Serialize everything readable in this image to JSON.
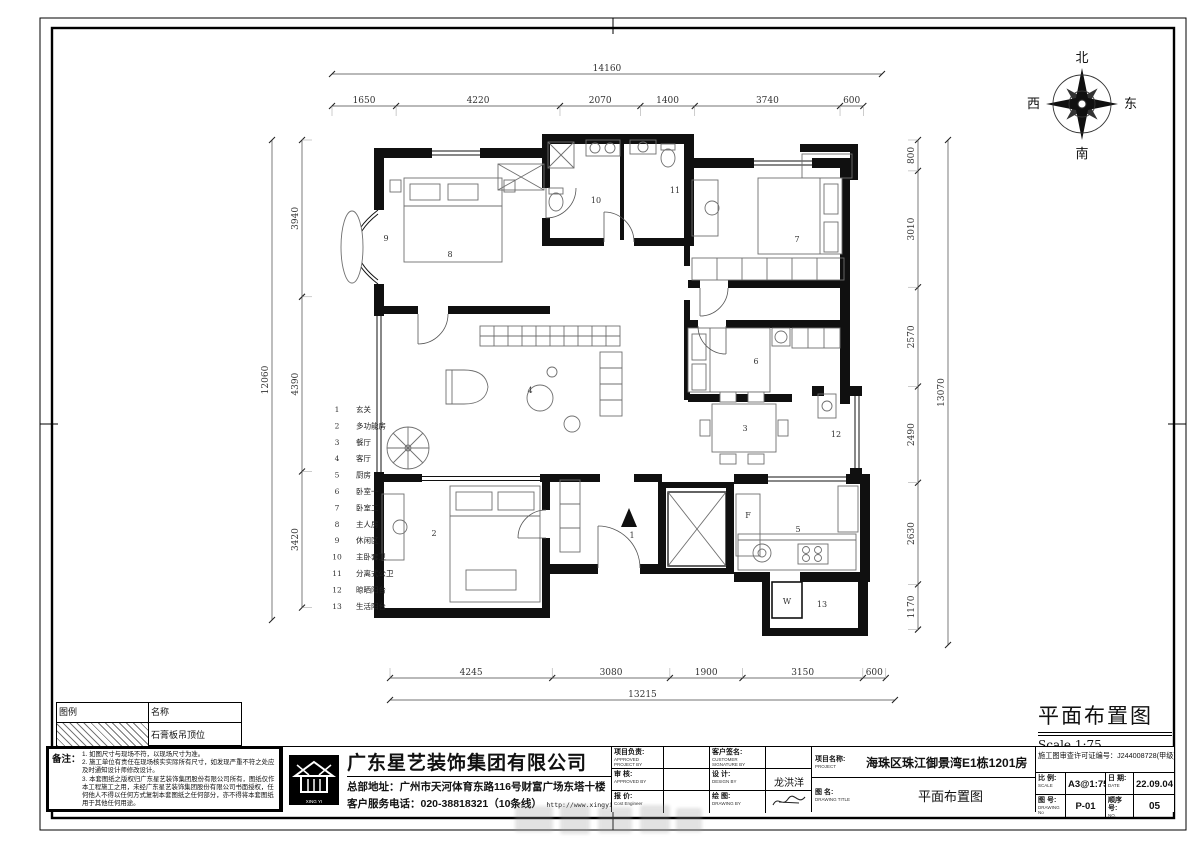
{
  "sheet": {
    "title": "平面布置图",
    "scale_label": "Scale 1:75"
  },
  "compass": {
    "north": "北",
    "south": "南",
    "east": "东",
    "west": "西"
  },
  "dimensions": {
    "top": {
      "total": "14160",
      "segments": [
        "1650",
        "4220",
        "2070",
        "1400",
        "3740",
        "600"
      ]
    },
    "bottom": {
      "total": "13215",
      "segments": [
        "4245",
        "3080",
        "1900",
        "3150",
        "600"
      ]
    },
    "left": {
      "total": "12060",
      "segments": [
        "3940",
        "4390",
        "3420"
      ]
    },
    "right": {
      "total": "13070",
      "segments": [
        "800",
        "3010",
        "2570",
        "2490",
        "2630",
        "1170"
      ]
    }
  },
  "room_index": [
    {
      "no": "1",
      "name": "玄关"
    },
    {
      "no": "2",
      "name": "多功能房"
    },
    {
      "no": "3",
      "name": "餐厅"
    },
    {
      "no": "4",
      "name": "客厅"
    },
    {
      "no": "5",
      "name": "厨房"
    },
    {
      "no": "6",
      "name": "卧室一"
    },
    {
      "no": "7",
      "name": "卧室二"
    },
    {
      "no": "8",
      "name": "主人房"
    },
    {
      "no": "9",
      "name": "休闲区"
    },
    {
      "no": "10",
      "name": "主卧套卫"
    },
    {
      "no": "11",
      "name": "分离式公卫"
    },
    {
      "no": "12",
      "name": "晾晒阳台"
    },
    {
      "no": "13",
      "name": "生活阳台"
    }
  ],
  "plan": {
    "fridge_label": "F",
    "washer_label": "W"
  },
  "legend": {
    "header_symbol": "图例",
    "header_name": "名称",
    "row_name": "石膏板吊顶位"
  },
  "notes": {
    "label": "备注：",
    "lines": [
      "1. 如图尺寸与现场不符，以现场尺寸为准。",
      "2. 施工单位有责任在现场核实实际所有尺寸，如发现严重不符之处应及时通知设计师修改设计。",
      "3. 本套图纸之版权归广东星艺装饰集团股份有限公司所有，图纸仅作本工程施工之用，未经广东星艺装饰集团股份有限公司书面授权，任何他人不得以任何方式复制本套图纸之任何部分，亦不得将本套图纸用于其他任何用途。"
    ]
  },
  "company": {
    "name": "广东星艺装饰集团有限公司",
    "address": "总部地址：广州市天河体育东路116号财富广场东塔十楼",
    "phone": "客户服务电话：020-38818321（10条线）",
    "url": "http://www.xingyigz.com.cn",
    "logo_caption": "XING YI"
  },
  "titleblock": {
    "cells": [
      {
        "zh": "项目负责:",
        "en": "APPROVED PROJECT BY",
        "value": ""
      },
      {
        "zh": "客户签名:",
        "en": "CUSTOMER SIGNATURE BY",
        "value": ""
      },
      {
        "zh": "审 核:",
        "en": "APPROVED BY",
        "value": ""
      },
      {
        "zh": "设 计:",
        "en": "DESIGN BY",
        "value": "龙洪洋"
      },
      {
        "zh": "报 价:",
        "en": "Cost Engineer",
        "value": ""
      },
      {
        "zh": "绘 图:",
        "en": "DRAWING BY",
        "value": ""
      }
    ],
    "project_zh": "项目名称:",
    "project_en": "PROJECT",
    "project_value": "海珠区珠江御景湾E1栋1201房",
    "title_zh": "图 名:",
    "title_en": "DRAWING TITLE",
    "permit": "施工图审查许可证编号：J244008728(甲级)",
    "scale_zh": "比 例:",
    "scale_en": "SCALE",
    "scale_value": "A3@1:75",
    "date_zh": "日 期:",
    "date_en": "DATE",
    "date_value": "22.09.04",
    "no_zh": "图 号:",
    "no_en": "DRAWING No",
    "no_value": "P-01",
    "seq_zh": "顺序号:",
    "seq_en": "NO.",
    "seq_value": "05"
  }
}
